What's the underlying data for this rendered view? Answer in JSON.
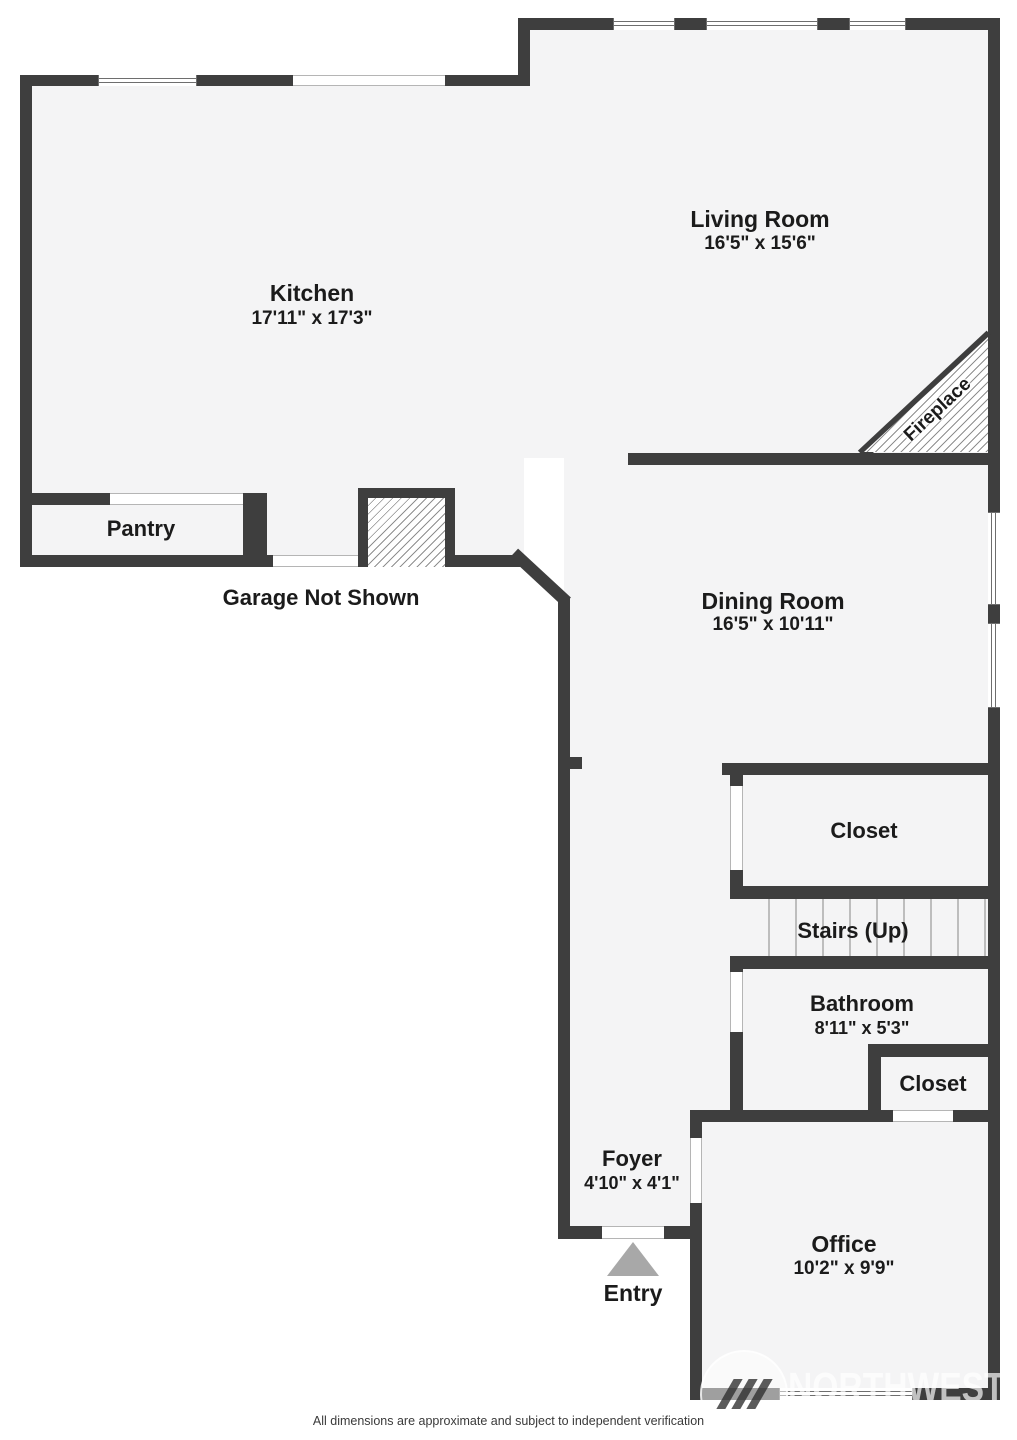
{
  "labels": {
    "kitchen": {
      "name": "Kitchen",
      "dims": "17'11\" x 17'3\""
    },
    "living": {
      "name": "Living Room",
      "dims": "16'5\" x 15'6\""
    },
    "dining": {
      "name": "Dining Room",
      "dims": "16'5\" x 10'11\""
    },
    "bathroom": {
      "name": "Bathroom",
      "dims": "8'11\" x 5'3\""
    },
    "foyer": {
      "name": "Foyer",
      "dims": "4'10\" x 4'1\""
    },
    "office": {
      "name": "Office",
      "dims": "10'2\" x 9'9\""
    },
    "pantry": "Pantry",
    "closet1": "Closet",
    "stairs": "Stairs (Up)",
    "closet2": "Closet",
    "fireplace": "Fireplace",
    "garage_note": "Garage Not Shown",
    "entry": "Entry"
  },
  "footer": {
    "disclaimer": "All dimensions are approximate and subject to independent verification"
  },
  "watermark": {
    "text": "NORTHWEST"
  },
  "colors": {
    "wall": "#3e3e3e",
    "floor": "#f4f4f5",
    "background": "#ffffff",
    "text": "#1b1b1b",
    "entry_arrow": "#a8a8a8"
  }
}
